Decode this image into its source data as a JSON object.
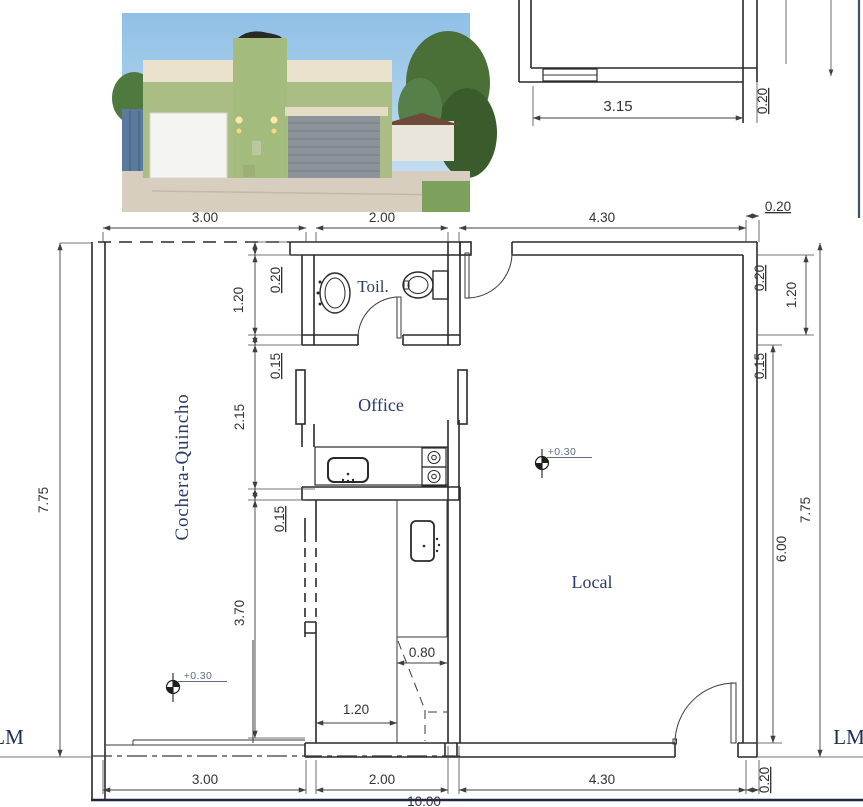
{
  "drawing": {
    "rooms": {
      "cochera": "Cochera-Quincho",
      "office": "Office",
      "toilet": "Toil.",
      "local": "Local"
    },
    "boundary": {
      "lm_left": "LM",
      "lm_right": "LM"
    },
    "levels": {
      "local": "+0.30",
      "cochera": "+0.30"
    },
    "dims": {
      "upper_width": "3.15",
      "upper_wall": "0.20",
      "top_wall": "0.20",
      "top_cochera": "3.00",
      "top_toilet": "2.00",
      "top_local": "4.30",
      "left_total": "7.75",
      "left_chain": {
        "wall_top": "0.20",
        "toilet_depth": "1.20",
        "wall_mid": "0.15",
        "office_depth": "2.15",
        "wall_kitchen": "0.15",
        "cochera_depth": "3.70"
      },
      "right_chain": {
        "wall_top": "0.20",
        "toilet_depth": "1.20",
        "wall_mid": "0.15",
        "local_depth": "6.00",
        "total": "7.75",
        "bottom_wall": "0.20"
      },
      "bottom_cochera": "3.00",
      "bottom_toilet": "2.00",
      "bottom_local": "4.30",
      "bottom_wall": "0.20",
      "bottom_total": "10.00",
      "closet_width": "0.80",
      "opening_width": "1.20"
    },
    "colors": {
      "wall_line": "#2a2a2a",
      "room_label": "#2a3b66",
      "dim_text": "#333333",
      "level_text": "#5d6b85",
      "border_bottom": "#1c2742",
      "border_right": "#3e4e6a",
      "photo_sky": "#9ac8ea",
      "photo_wall_green": "#a9bd85",
      "photo_band_cream": "#eae2cc",
      "photo_shutter_gray": "#8d939b"
    }
  }
}
